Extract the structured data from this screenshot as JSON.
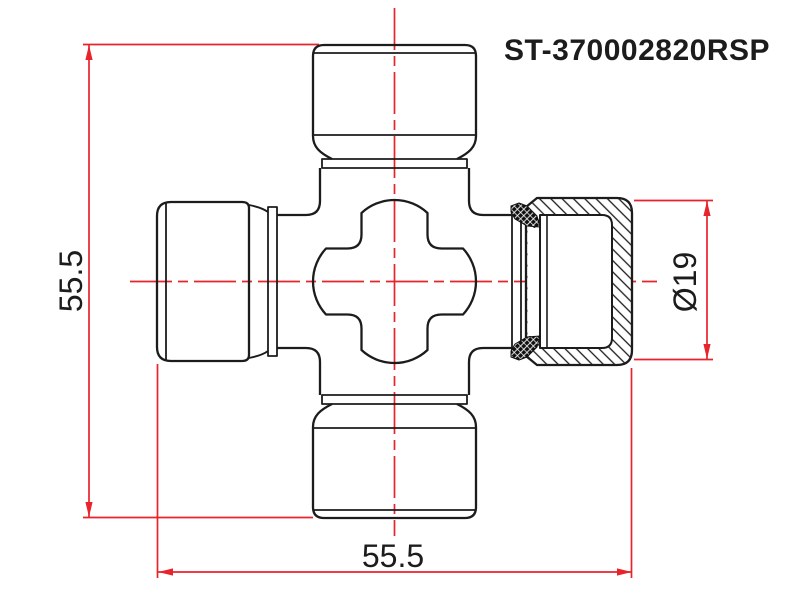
{
  "part_number": "ST-370002820RSP",
  "dimensions": {
    "overall_height": "55.5",
    "overall_width": "55.5",
    "cap_diameter": "Ø19"
  },
  "colors": {
    "dimension_red": "#e8232b",
    "outline_black": "#1c1c1c",
    "background": "#ffffff"
  },
  "drawing": {
    "kind": "technical-line-drawing",
    "subject": "universal-joint-cross-with-bearing-caps-right-cap-in-section"
  }
}
